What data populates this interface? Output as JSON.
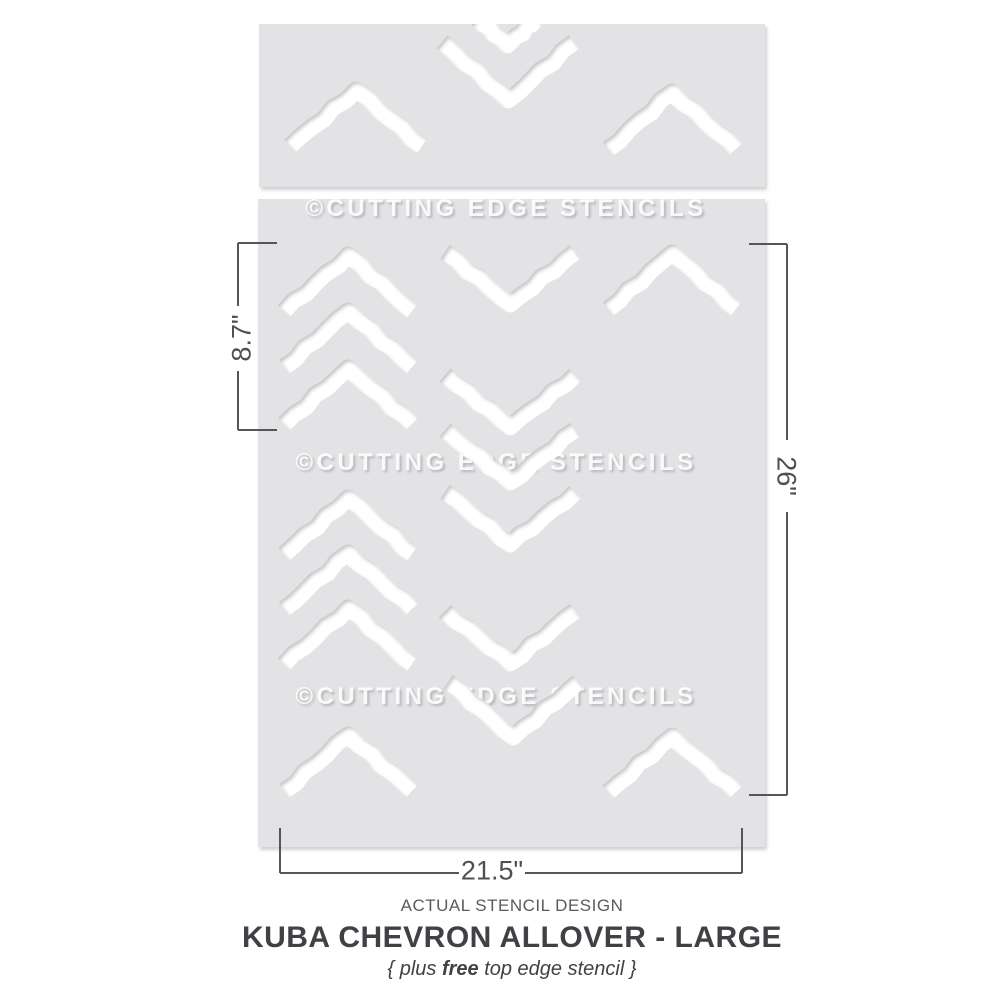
{
  "caption": {
    "eyebrow": "ACTUAL STENCIL DESIGN",
    "title": "KUBA CHEVRON ALLOVER - LARGE",
    "subtitle_prefix": "{ plus ",
    "subtitle_bold": "free",
    "subtitle_suffix": " top edge stencil }"
  },
  "watermark": {
    "text": "©CUTTING EDGE STENCILS",
    "positions": [
      [
        506,
        209
      ],
      [
        496,
        463
      ],
      [
        496,
        697
      ]
    ]
  },
  "colors": {
    "sheet": "#e3e3e5",
    "cut": "#ffffff",
    "line": "#55565b",
    "shadow": "#8f8f96"
  },
  "sheets": [
    {
      "name": "top-edge-stencil-sheet",
      "x": 259,
      "y": 24,
      "w": 506,
      "h": 163
    },
    {
      "name": "main-stencil-sheet",
      "x": 258,
      "y": 199,
      "w": 507,
      "h": 648
    }
  ],
  "marks": [
    {
      "s": 0,
      "t": "down",
      "x": 507,
      "y": 45,
      "hw": 29,
      "hh": 26
    },
    {
      "s": 0,
      "t": "down",
      "x": 508,
      "y": 100,
      "hw": 66,
      "hh": 58
    },
    {
      "s": 0,
      "t": "up",
      "x": 356,
      "y": 90,
      "hw": 66,
      "hh": 56
    },
    {
      "s": 0,
      "t": "up",
      "x": 672,
      "y": 92,
      "hw": 64,
      "hh": 57
    },
    {
      "s": 1,
      "t": "up",
      "x": 348,
      "y": 255,
      "hw": 64,
      "hh": 56
    },
    {
      "s": 1,
      "t": "up",
      "x": 348,
      "y": 311,
      "hw": 64,
      "hh": 56
    },
    {
      "s": 1,
      "t": "up",
      "x": 348,
      "y": 368,
      "hw": 64,
      "hh": 56
    },
    {
      "s": 1,
      "t": "up",
      "x": 348,
      "y": 498,
      "hw": 64,
      "hh": 56
    },
    {
      "s": 1,
      "t": "up",
      "x": 348,
      "y": 553,
      "hw": 64,
      "hh": 56
    },
    {
      "s": 1,
      "t": "up",
      "x": 348,
      "y": 608,
      "hw": 64,
      "hh": 56
    },
    {
      "s": 1,
      "t": "up",
      "x": 348,
      "y": 735,
      "hw": 64,
      "hh": 56
    },
    {
      "s": 1,
      "t": "down",
      "x": 510,
      "y": 304,
      "hw": 65,
      "hh": 52
    },
    {
      "s": 1,
      "t": "down",
      "x": 510,
      "y": 427,
      "hw": 65,
      "hh": 52
    },
    {
      "s": 1,
      "t": "down",
      "x": 510,
      "y": 482,
      "hw": 65,
      "hh": 52
    },
    {
      "s": 1,
      "t": "down",
      "x": 510,
      "y": 544,
      "hw": 65,
      "hh": 52
    },
    {
      "s": 1,
      "t": "down",
      "x": 510,
      "y": 663,
      "hw": 65,
      "hh": 52
    },
    {
      "s": 1,
      "t": "down",
      "x": 513,
      "y": 737,
      "hw": 65,
      "hh": 55
    },
    {
      "s": 1,
      "t": "up",
      "x": 672,
      "y": 253,
      "hw": 64,
      "hh": 56
    },
    {
      "s": 1,
      "t": "up",
      "x": 672,
      "y": 736,
      "hw": 64,
      "hh": 56
    }
  ],
  "dims": [
    {
      "label": "8.7\"",
      "rot": -90,
      "lx": 242,
      "ly": 338,
      "lines": [
        [
          238,
          243,
          277,
          243
        ],
        [
          238,
          243,
          238,
          306
        ],
        [
          238,
          371,
          238,
          430
        ],
        [
          238,
          430,
          277,
          430
        ]
      ]
    },
    {
      "label": "26\"",
      "rot": 90,
      "lx": 786,
      "ly": 476,
      "lines": [
        [
          749,
          244,
          787,
          244
        ],
        [
          787,
          244,
          787,
          440
        ],
        [
          787,
          512,
          787,
          795
        ],
        [
          749,
          795,
          787,
          795
        ]
      ]
    },
    {
      "label": "21.5\"",
      "rot": 0,
      "lx": 492,
      "ly": 871,
      "lines": [
        [
          280,
          828,
          280,
          873
        ],
        [
          280,
          873,
          459,
          873
        ],
        [
          525,
          873,
          742,
          873
        ],
        [
          742,
          828,
          742,
          873
        ]
      ]
    }
  ]
}
